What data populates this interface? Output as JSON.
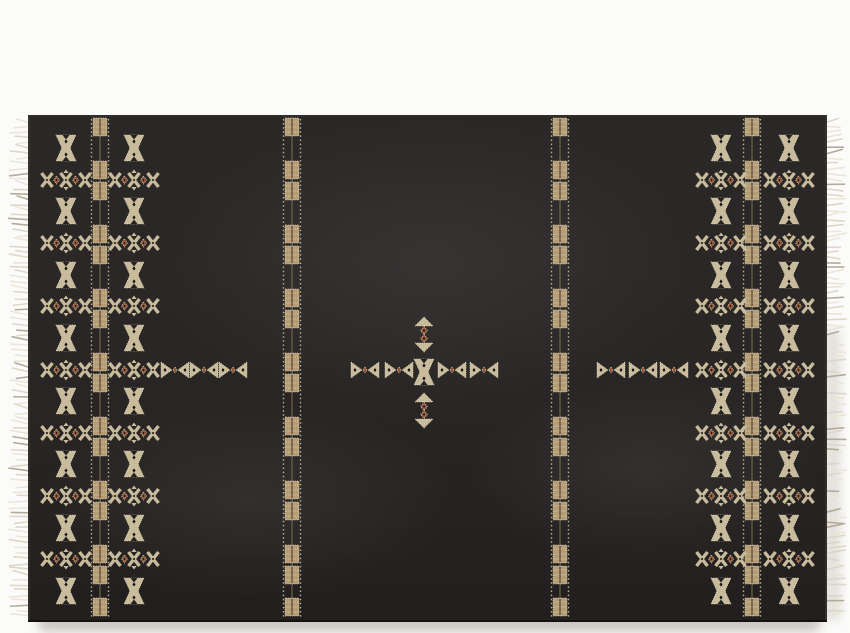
{
  "scene": {
    "description": "Black flat-woven area rug with cream, tan and rust tribal embroidered motifs and ivory fringe on the short ends, photographed flat on a white background",
    "background_color": "#fbfbfa"
  },
  "rug": {
    "x": 28,
    "y": 115,
    "width": 799,
    "height": 507,
    "base_color": "#242120",
    "edge_color": "#403a2e",
    "shadow_color": "#c2beb8"
  },
  "palette": {
    "cream": "#c8bc9d",
    "light_cream": "#ddd3b4",
    "tan": "#b49c74",
    "rust": "#99573a",
    "rust_soft": "#8a5c40",
    "dark_dot": "#15120f",
    "fringe": "#ddd6c5",
    "fringe_light": "#ebe5d7",
    "fringe_shadow": "#b0a896",
    "stripe_line": "#c3b795",
    "connector": "#8a7d5e"
  },
  "motifs": {
    "names": [
      "butterfly-bowtie",
      "diamond-chevron-band",
      "stripe-medallion-block",
      "arrow-bowtie",
      "center-cross-stack"
    ]
  },
  "layout": {
    "stripes": {
      "x_centers": [
        100,
        292,
        560,
        752
      ],
      "line_half_gap": 8.5,
      "y_top": 119,
      "y_bottom": 618,
      "block_ys": [
        127,
        170,
        191,
        234,
        255,
        298,
        319,
        362,
        383,
        426,
        447,
        490,
        511,
        554,
        575,
        607
      ]
    },
    "columns": {
      "x_centers": [
        66,
        134,
        721,
        789
      ],
      "row_ys": [
        148,
        180,
        211,
        243,
        275,
        306,
        338,
        370,
        401,
        433,
        464,
        496,
        528,
        559,
        591
      ],
      "row_pattern": "alternate bowtie / band, starting with bowtie"
    },
    "mid_row": {
      "y": 370,
      "bowtie_xs": [
        175,
        204,
        233,
        365,
        399,
        452,
        484,
        611,
        643,
        674
      ]
    },
    "center_stack": {
      "x": 424,
      "segment_ys": [
        334,
        372,
        410
      ],
      "segment_types": [
        "fan-diamonds",
        "bowtie",
        "fan-diamonds"
      ]
    },
    "fringe": {
      "strand_spacing": 5.2,
      "min_length": 12,
      "max_length": 21,
      "y_top": 121,
      "y_bottom": 618
    }
  }
}
